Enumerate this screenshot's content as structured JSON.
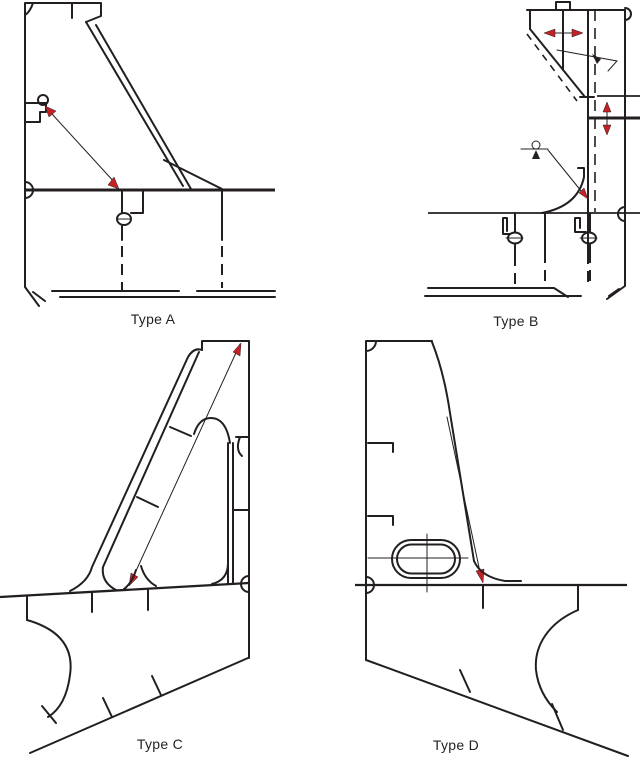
{
  "figure": {
    "panels": [
      {
        "id": "type-a",
        "label": "Type A"
      },
      {
        "id": "type-b",
        "label": "Type B"
      },
      {
        "id": "type-c",
        "label": "Type C"
      },
      {
        "id": "type-d",
        "label": "Type D"
      }
    ]
  },
  "colors": {
    "background": "#ffffff",
    "line": "#231f20",
    "arrow_red": "#c42127"
  }
}
